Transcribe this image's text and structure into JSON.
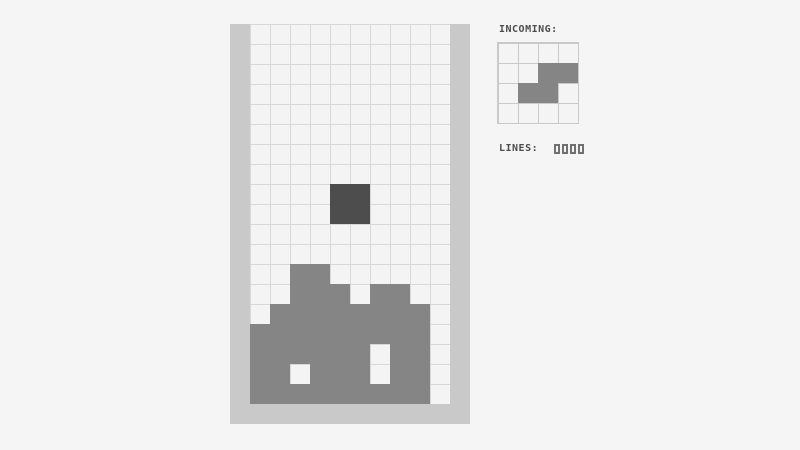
{
  "page": {
    "background_color": "#f5f5f5"
  },
  "board": {
    "columns": 10,
    "rows": 19,
    "cell_size_px": 20,
    "frame_color": "#c9c9c9",
    "grid_line_color": "#d8d8d8",
    "empty_cell_color": "#f4f4f4",
    "stack_color": "#858585",
    "active_piece_color": "#4d4d4d",
    "active_piece": {
      "piece_type": "O",
      "cells": [
        [
          4,
          8
        ],
        [
          5,
          8
        ],
        [
          4,
          9
        ],
        [
          5,
          9
        ]
      ]
    },
    "stack_cells": [
      [
        2,
        12
      ],
      [
        3,
        12
      ],
      [
        2,
        13
      ],
      [
        3,
        13
      ],
      [
        4,
        13
      ],
      [
        6,
        13
      ],
      [
        7,
        13
      ],
      [
        1,
        14
      ],
      [
        2,
        14
      ],
      [
        3,
        14
      ],
      [
        4,
        14
      ],
      [
        5,
        14
      ],
      [
        6,
        14
      ],
      [
        7,
        14
      ],
      [
        8,
        14
      ],
      [
        0,
        15
      ],
      [
        1,
        15
      ],
      [
        2,
        15
      ],
      [
        3,
        15
      ],
      [
        4,
        15
      ],
      [
        5,
        15
      ],
      [
        6,
        15
      ],
      [
        7,
        15
      ],
      [
        8,
        15
      ],
      [
        0,
        16
      ],
      [
        1,
        16
      ],
      [
        2,
        16
      ],
      [
        3,
        16
      ],
      [
        4,
        16
      ],
      [
        5,
        16
      ],
      [
        7,
        16
      ],
      [
        8,
        16
      ],
      [
        0,
        17
      ],
      [
        1,
        17
      ],
      [
        3,
        17
      ],
      [
        4,
        17
      ],
      [
        5,
        17
      ],
      [
        7,
        17
      ],
      [
        8,
        17
      ],
      [
        0,
        18
      ],
      [
        1,
        18
      ],
      [
        2,
        18
      ],
      [
        3,
        18
      ],
      [
        4,
        18
      ],
      [
        5,
        18
      ],
      [
        6,
        18
      ],
      [
        7,
        18
      ],
      [
        8,
        18
      ]
    ]
  },
  "panel": {
    "text_color": "#4d4d4d",
    "incoming_label": "INCOMING:",
    "incoming_preview": {
      "columns": 4,
      "rows": 4,
      "cell_size_px": 20,
      "grid_line_color": "#c9c9c9",
      "background_color": "#f4f4f4",
      "piece_color": "#858585",
      "piece_type": "S",
      "cells": [
        [
          2,
          1
        ],
        [
          3,
          1
        ],
        [
          1,
          2
        ],
        [
          2,
          2
        ]
      ]
    },
    "lines_label": "LINES:",
    "lines_value": "0000",
    "lines_digit_color": "#707070"
  }
}
